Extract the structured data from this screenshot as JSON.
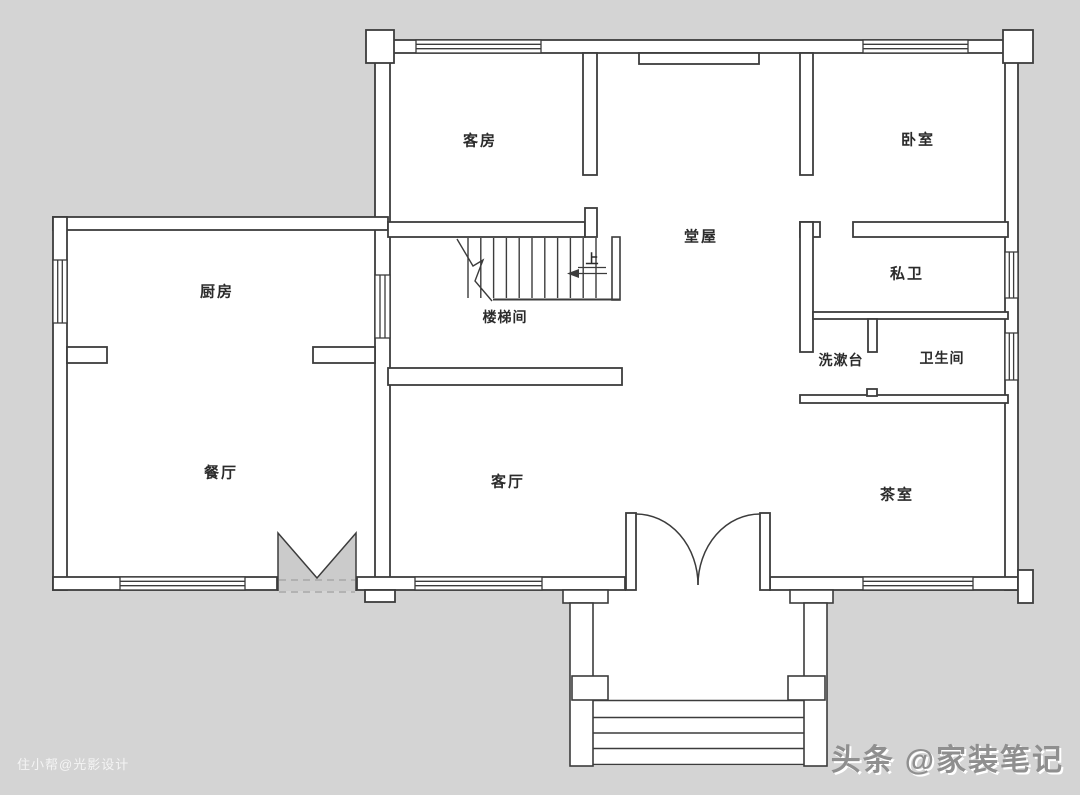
{
  "colors": {
    "background": "#d4d4d4",
    "floor": "#ffffff",
    "wall_line": "#3c3c3c",
    "folding_door_fill": "#cbcbcb"
  },
  "floor_plan": {
    "rooms": {
      "guest_room": {
        "label": "客房"
      },
      "bedroom": {
        "label": "卧室"
      },
      "hall": {
        "label": "堂屋"
      },
      "kitchen": {
        "label": "厨房"
      },
      "stairwell": {
        "label": "楼梯间"
      },
      "private_bath": {
        "label": "私卫"
      },
      "washstand": {
        "label": "洗漱台"
      },
      "bathroom": {
        "label": "卫生间"
      },
      "dining_room": {
        "label": "餐厅"
      },
      "living_room": {
        "label": "客厅"
      },
      "tea_room": {
        "label": "茶室"
      }
    },
    "stairs": {
      "direction_label": "上"
    }
  },
  "watermarks": {
    "bottom_left": "住小帮@光影设计",
    "bottom_right_brand": "头条",
    "bottom_right_handle": "@家装笔记"
  }
}
